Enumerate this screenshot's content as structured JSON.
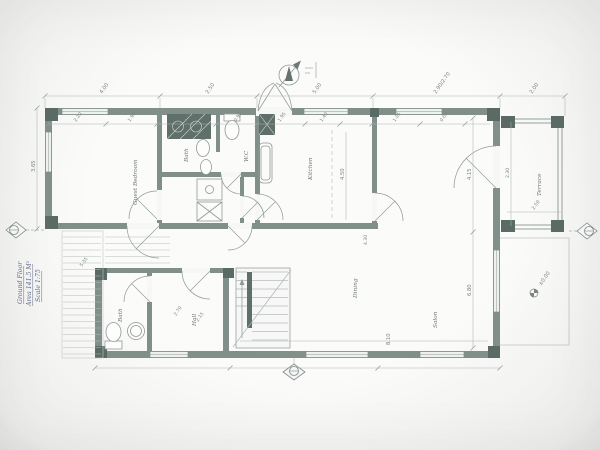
{
  "plan": {
    "title_block": {
      "line1": "Ground Floor",
      "line2": "Area 141.5 M²",
      "line3": "Scale 1:75"
    },
    "level_marker": "±0.00",
    "rooms": [
      {
        "name": "Guest Bedroom"
      },
      {
        "name": "Bath"
      },
      {
        "name": "W.C"
      },
      {
        "name": "Kitchen"
      },
      {
        "name": "Dining"
      },
      {
        "name": "Salon"
      },
      {
        "name": "Terrace"
      },
      {
        "name": "Bath"
      },
      {
        "name": "Hall"
      }
    ],
    "dims": {
      "top": [
        "4.00",
        "2.50",
        "5.00",
        "2.90/2.70",
        "2.00"
      ],
      "top_inner": [
        "2.20",
        "1.90",
        "1.10",
        "0.90",
        "1.95",
        "1.40",
        "1.05",
        "0.60"
      ],
      "left": [
        "3.65"
      ],
      "kitchen": [
        "4.50"
      ],
      "salon": [
        "4.15",
        "6.80",
        "8.10",
        "4.30"
      ],
      "terrace": [
        "2.30",
        "2.50"
      ],
      "hall": [
        "2.70",
        "2.15"
      ],
      "porch": [
        "5.35"
      ]
    },
    "colors": {
      "wall": "#7b8a85",
      "pillar": "#5a6a64",
      "line": "#9aa4a0",
      "dim": "#adb5b2",
      "text": "#6e7a76",
      "title": "#5f6b8c",
      "paper": "#f7f7f5"
    }
  }
}
